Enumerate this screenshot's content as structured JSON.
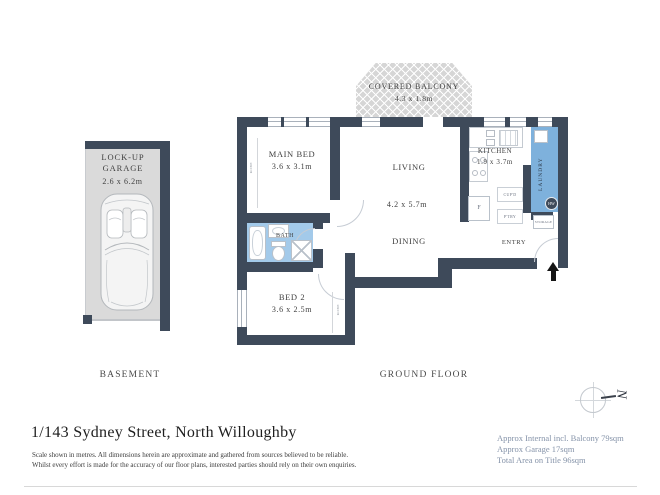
{
  "plan": {
    "levels": {
      "basement": "BASEMENT",
      "ground": "GROUND FLOOR"
    },
    "rooms": {
      "garage": {
        "name": "LOCK-UP GARAGE",
        "dims": "2.6 x 6.2m"
      },
      "balcony": {
        "name": "COVERED BALCONY",
        "dims": "4.3 x 1.8m"
      },
      "main_bed": {
        "name": "MAIN BED",
        "dims": "3.6 x 3.1m"
      },
      "living": {
        "name": "LIVING",
        "dims": "4.2 x 5.7m"
      },
      "dining": {
        "name": "DINING"
      },
      "kitchen": {
        "name": "KITCHEN",
        "dims": "1.9 x 3.7m"
      },
      "laundry": {
        "name": "LAUNDRY"
      },
      "bath": {
        "name": "BATH"
      },
      "bed2": {
        "name": "BED 2",
        "dims": "3.6 x 2.5m"
      },
      "entry": {
        "name": "ENTRY"
      },
      "storage": {
        "name": "STORAGE"
      }
    },
    "fixtures": {
      "fridge": "F",
      "hot_water": "HW",
      "cupboard": "CUP'D",
      "pantry": "P'TRY",
      "robe": "ROBE"
    },
    "compass": {
      "north": "N"
    }
  },
  "footer": {
    "address": "1/143 Sydney Street, North Willoughby",
    "disclaimer1": "Scale shown in metres. All dimensions herein are approximate and gathered from sources believed to be reliable.",
    "disclaimer2": "Whilst every effort is made for the accuracy of our floor plans, interested parties should rely on their own enquiries.",
    "areas": [
      "Approx Internal incl. Balcony 79sqm",
      "Approx Garage 17sqm",
      "Total Area on Title 96sqm"
    ]
  },
  "colors": {
    "wall": "#3E4A5A",
    "bath_blue": "#A3CAEA",
    "laundry_blue": "#7EB1DC",
    "garage_grey": "#DADADA",
    "area_text": "#8593A9"
  }
}
